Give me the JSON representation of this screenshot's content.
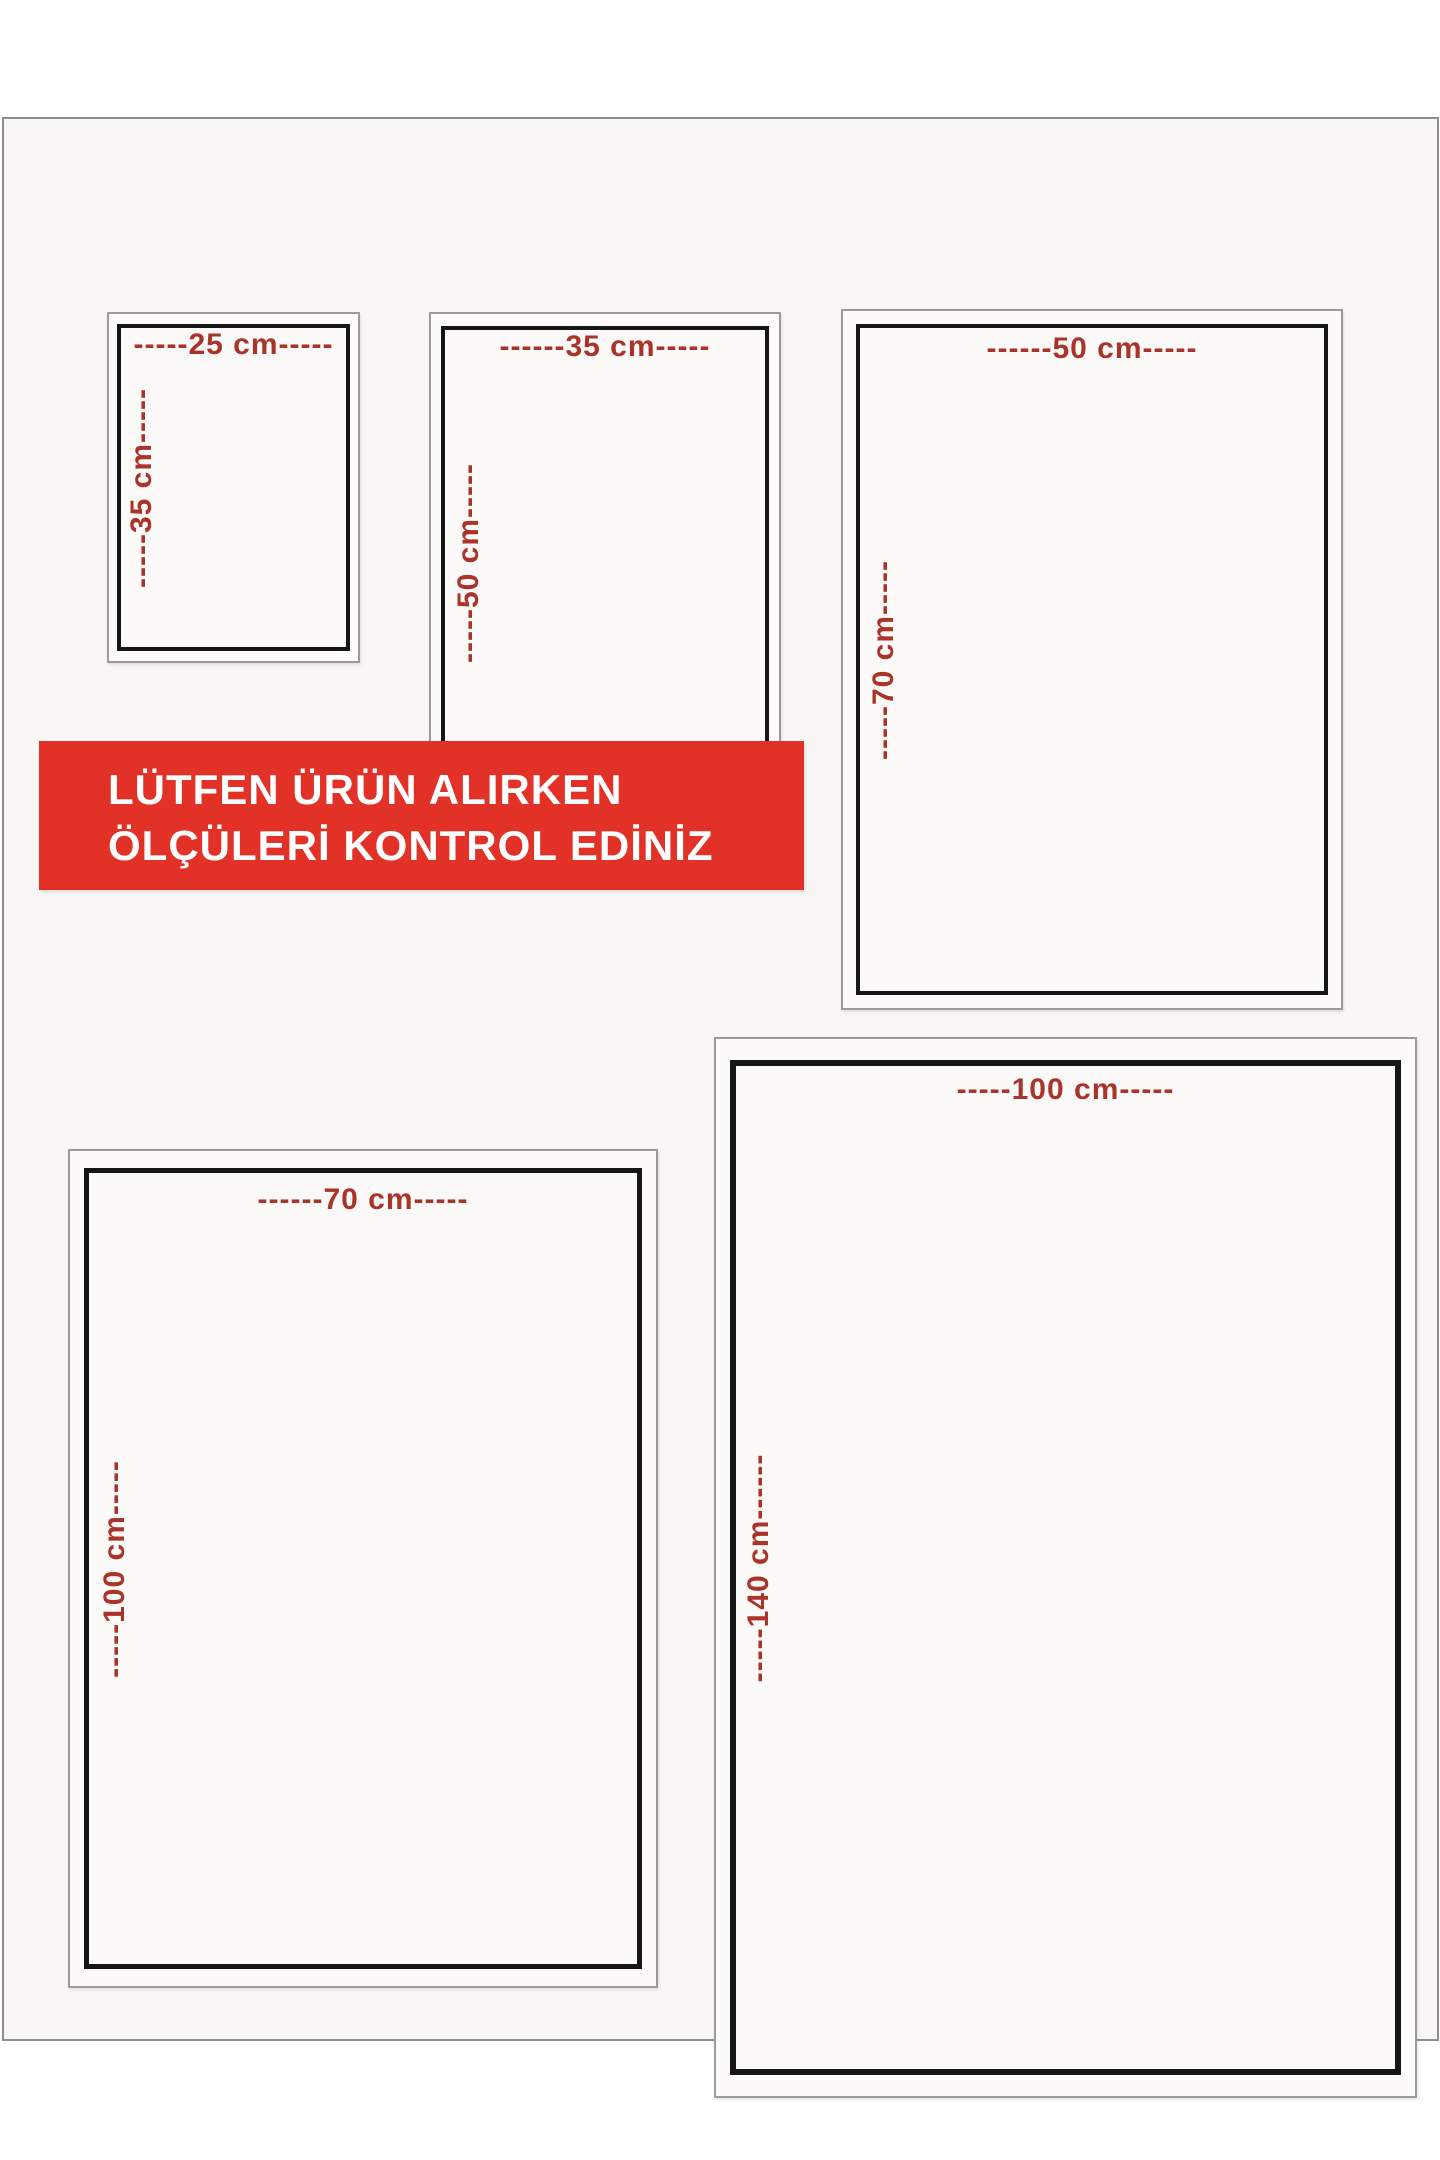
{
  "banner": {
    "line1": "LÜTFEN ÜRÜN ALIRKEN",
    "line2": "ÖLÇÜLERİ KONTROL EDİNİZ",
    "background": "#e23127",
    "text_color": "#ffffff"
  },
  "colors": {
    "dimension_label_red": "#aa332a",
    "inner_border_black": "#161616",
    "outer_border_gray": "#9b9b9b",
    "frame_gray": "#8f8f8f",
    "page_fill": "#f8f7f5"
  },
  "boxes": [
    {
      "name": "25x35",
      "width_cm": 25,
      "height_cm": 35,
      "top_label": "-----25 cm-----",
      "side_label": "-----35 cm-----"
    },
    {
      "name": "35x50",
      "width_cm": 35,
      "height_cm": 50,
      "top_label": "------35 cm-----",
      "side_label": "-----50 cm-----"
    },
    {
      "name": "50x70",
      "width_cm": 50,
      "height_cm": 70,
      "top_label": "------50 cm-----",
      "side_label": "-----70 cm-----"
    },
    {
      "name": "70x100",
      "width_cm": 70,
      "height_cm": 100,
      "top_label": "------70 cm-----",
      "side_label": "-----100 cm-----"
    },
    {
      "name": "100x140",
      "width_cm": 100,
      "height_cm": 140,
      "top_label": "-----100 cm-----",
      "side_label": "-----140 cm------"
    }
  ]
}
